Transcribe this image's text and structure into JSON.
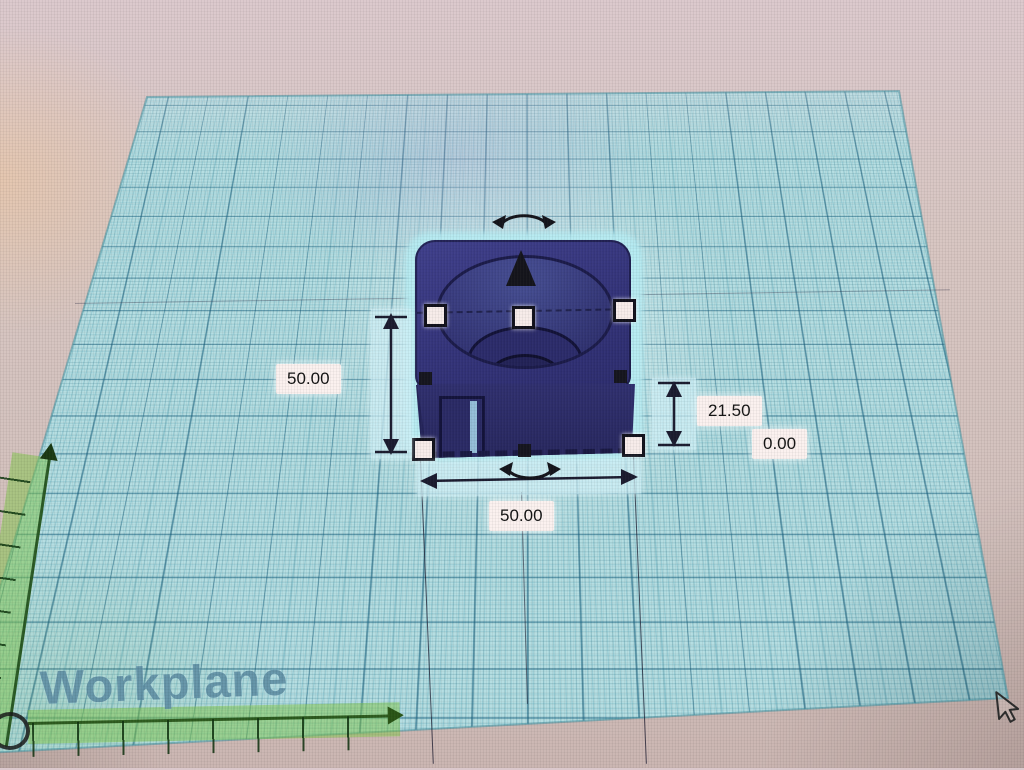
{
  "workplane": {
    "label": "Workplane"
  },
  "dimensions": {
    "left": "50.00",
    "width": "50.00",
    "height": "21.50",
    "elevation": "0.00"
  },
  "icons": {
    "raise_handle": "cone-up-arrow",
    "rotate_handle": "curved-double-arrow",
    "scale_handle_corner": "white-square",
    "scale_handle_edge": "black-square",
    "dimension_arrow": "double-headed-arrow",
    "ruler_origin": "circle-outline",
    "ruler_axis": "green-arrow-ruler",
    "cursor": "arrow-pointer"
  },
  "colors": {
    "plane": "#b5dee2",
    "grid_major": "#2a7a96",
    "object_body": "#35357a",
    "selection_glow": "#bfeef2",
    "ruler_green": "#7cc044",
    "label_background": "#fbf1ef",
    "label_text": "#141414",
    "workplane_text": "#5c8ca2"
  }
}
